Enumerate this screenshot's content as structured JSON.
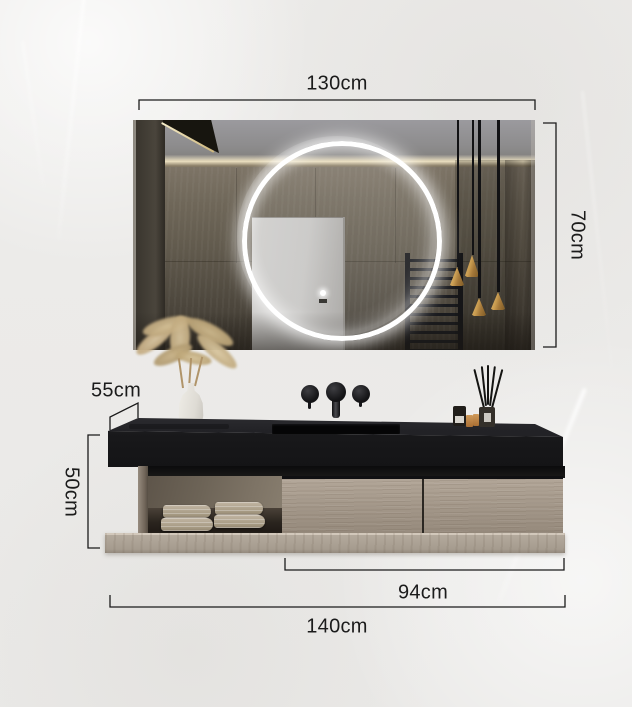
{
  "annotations": {
    "mirror_width": "130cm",
    "mirror_height": "70cm",
    "counter_depth": "55cm",
    "cabinet_height": "50cm",
    "drawers_width": "94cm",
    "overall_width": "140cm"
  },
  "style": {
    "annotation_color": "#1b1b1b",
    "background_color": "#edecea",
    "counter_color": "#1c1c1e",
    "drawer_wood_color": "#a69a8c",
    "plinth_wood_color": "#b0a69a",
    "pendant_gold_color": "#c49a52",
    "led_ring_color": "#ffffff"
  },
  "scene": {
    "objects": [
      "led-ring-mirror",
      "pendant-lights",
      "wall-mounted-faucet",
      "black-stone-countertop",
      "integrated-sink",
      "pampas-grass-vase",
      "reed-diffuser-set",
      "open-shelf-with-towels",
      "wood-drawer-cabinet",
      "base-shelf"
    ]
  }
}
